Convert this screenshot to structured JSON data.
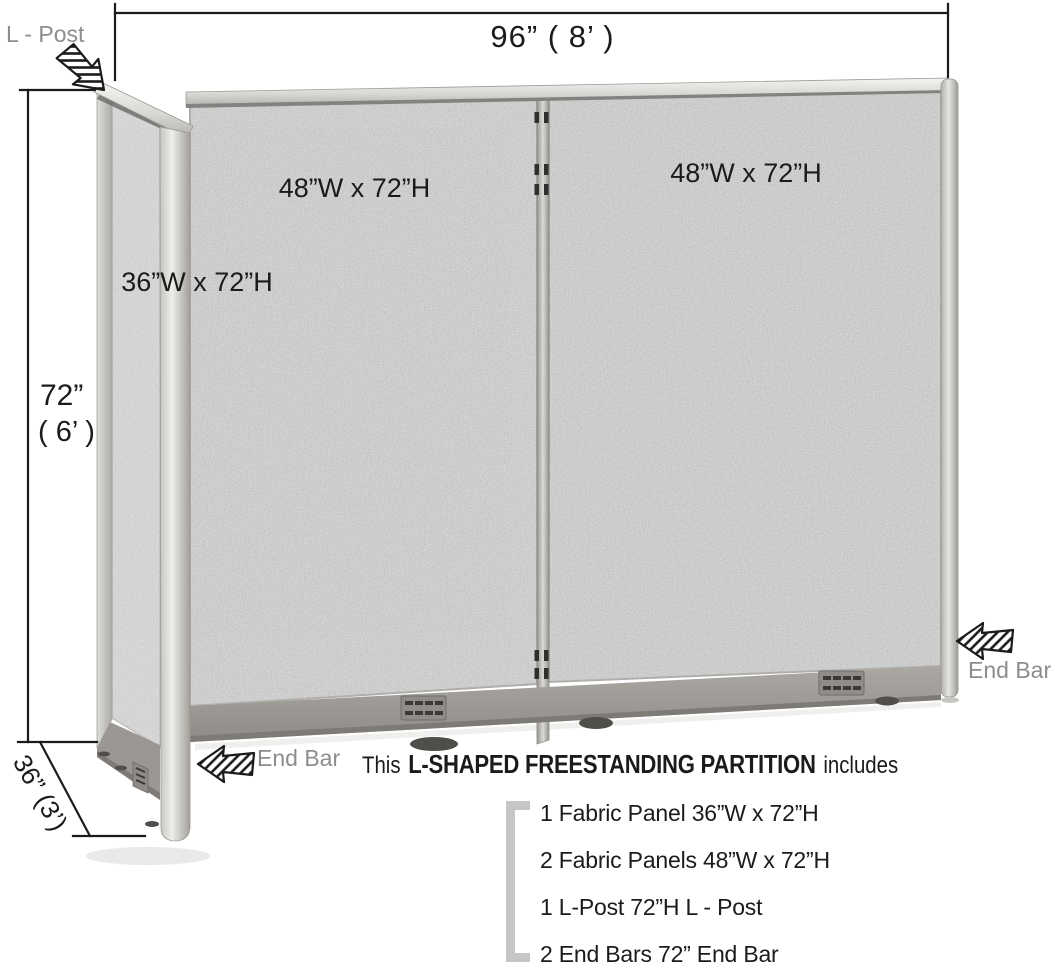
{
  "product": {
    "type": "L-Shaped Freestanding Partition",
    "overall_width_label": "96”  ( 8’ )",
    "overall_height_label_inches": "72”",
    "overall_height_label_feet": "( 6’ )",
    "return_depth_label": "36” (3’)"
  },
  "annotations": {
    "l_post_label": "L - Post",
    "top_dim": "96”  ( 8’ )",
    "left_dim_inches": "72”",
    "left_dim_feet": "( 6’ )",
    "depth_dim": "36” (3’)",
    "panel_left_label": "48”W x 72”H",
    "panel_right_label": "48”W x  72”H",
    "panel_side_label": "36”W x 72”H",
    "end_bar_right": "End Bar",
    "end_bar_bottom": "End Bar"
  },
  "description": {
    "prefix": "This",
    "highlight": "L-SHAPED FREESTANDING PARTITION",
    "suffix": "includes"
  },
  "includes_list": [
    "1 Fabric Panel  36”W x 72”H",
    "2 Fabric Panels  48”W x 72”H",
    "1 L-Post  72”H L - Post",
    "2 End Bars  72” End Bar"
  ],
  "icons": {
    "l_post_arrow": "hatched-arrow-down-right",
    "end_bar_right_arrow": "hatched-arrow-left",
    "end_bar_bottom_arrow": "hatched-arrow-left"
  },
  "colors": {
    "fabric": "#d4d6d5",
    "fabric_side": "#dcdddb",
    "frame_silver": "#c9c9c5",
    "base_rail": "#9b9893",
    "dimension_text": "#1b1b1b",
    "callout_gray": "#8d8d8d",
    "bracket_gray": "#c6c6c6",
    "background": "#ffffff"
  }
}
